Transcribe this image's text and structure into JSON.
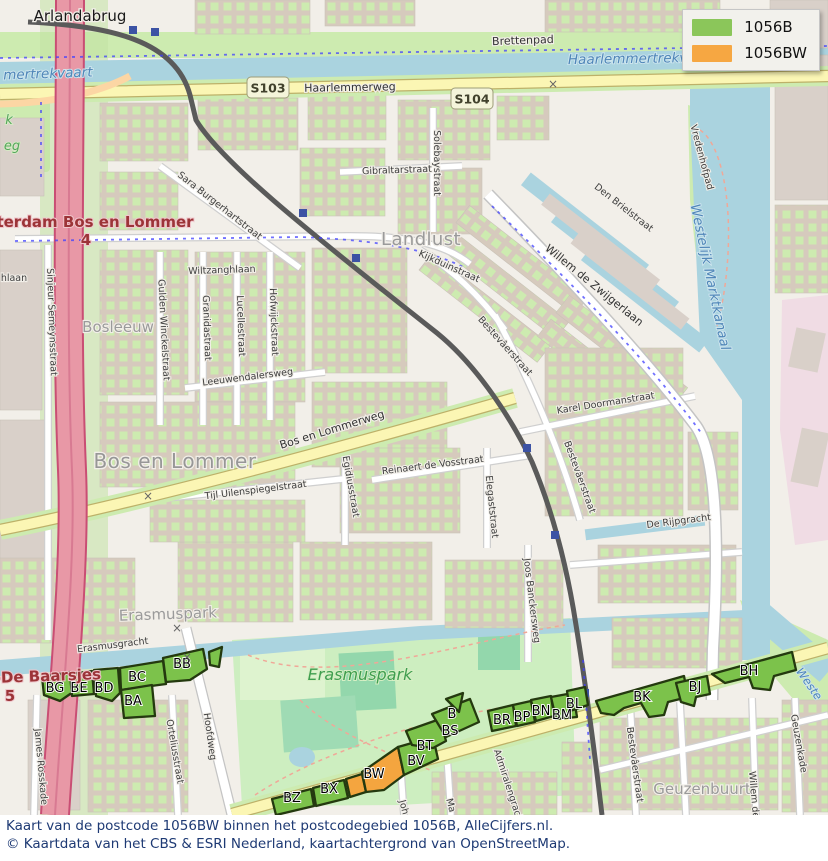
{
  "legend": {
    "items": [
      {
        "label": "1056B",
        "color": "#8bc65a"
      },
      {
        "label": "1056BW",
        "color": "#f6a742"
      }
    ]
  },
  "caption": {
    "line1": "Kaart van de postcode 1056BW binnen het postcodegebied 1056B, AlleCijfers.nl.",
    "line2": "© Kaartdata van het CBS & ESRI Nederland, kaartachtergrond van OpenStreetMap."
  },
  "map": {
    "colors": {
      "area_1056b": "#7cc24b",
      "area_1056bw": "#f4a53f",
      "area_outline": "#24390f",
      "water": "#aad3df",
      "land": "#f2efe9",
      "green": "#cdebb0",
      "motorway": "#e898a6",
      "road_yellow": "#fbf6b4"
    },
    "shields": [
      {
        "label": "S103",
        "x": 268,
        "y": 88
      },
      {
        "label": "S104",
        "x": 472,
        "y": 99
      }
    ],
    "areas": [
      {
        "label": "BG",
        "v": "B",
        "lx": 55,
        "ly": 692,
        "pts": "42,677 70,672 73,692 60,701 44,695"
      },
      {
        "label": "BE",
        "v": "B",
        "lx": 79,
        "ly": 692,
        "pts": "70,674 92,671 94,694 72,696"
      },
      {
        "label": "BD",
        "v": "B",
        "lx": 104,
        "ly": 692,
        "pts": "94,670 118,668 120,693 112,701 96,696"
      },
      {
        "label": "BC",
        "v": "B",
        "lx": 137,
        "ly": 681,
        "pts": "120,668 163,661 166,684 121,690"
      },
      {
        "label": "BA",
        "v": "B",
        "lx": 133,
        "ly": 705,
        "pts": "121,690 152,685 155,716 124,718"
      },
      {
        "label": "BB",
        "v": "B",
        "lx": 182,
        "ly": 668,
        "pts": "163,658 203,649 207,669 190,680 166,682"
      },
      {
        "label": "",
        "v": "B",
        "lx": 0,
        "ly": 0,
        "pts": "209,652 222,647 219,667 210,665"
      },
      {
        "label": "BZ",
        "v": "B",
        "lx": 292,
        "ly": 802,
        "pts": "272,799 311,789 314,806 276,815"
      },
      {
        "label": "BX",
        "v": "B",
        "lx": 329,
        "ly": 793,
        "pts": "313,788 344,780 348,798 316,806"
      },
      {
        "label": "",
        "v": "BW",
        "lx": 0,
        "ly": 0,
        "pts": "346,779 362,774 366,792 350,797"
      },
      {
        "label": "BW",
        "v": "BW",
        "lx": 374,
        "ly": 778,
        "pts": "362,772 398,747 404,775 384,790 366,792"
      },
      {
        "label": "BV",
        "v": "B",
        "lx": 416,
        "ly": 765,
        "pts": "398,747 433,737 438,759 404,775"
      },
      {
        "label": "BT",
        "v": "B",
        "lx": 425,
        "ly": 750,
        "pts": "406,731 440,719 446,741 433,748 412,745"
      },
      {
        "label": "BS",
        "v": "B",
        "lx": 450,
        "ly": 735,
        "pts": "432,714 470,699 479,722 446,737"
      },
      {
        "label": "B",
        "v": "B",
        "lx": 452,
        "ly": 718,
        "pts": "446,699 463,693 459,712"
      },
      {
        "label": "BR",
        "v": "B",
        "lx": 502,
        "ly": 724,
        "pts": "488,711 513,705 516,726 492,731"
      },
      {
        "label": "BP",
        "v": "B",
        "lx": 522,
        "ly": 721,
        "pts": "513,705 531,701 535,722 517,726"
      },
      {
        "label": "BN",
        "v": "B",
        "lx": 541,
        "ly": 715,
        "pts": "531,700 551,696 554,716 536,721"
      },
      {
        "label": "BM",
        "v": "B",
        "lx": 562,
        "ly": 719,
        "pts": "551,697 573,693 577,717 556,719"
      },
      {
        "label": "BL",
        "v": "B",
        "lx": 574,
        "ly": 708,
        "pts": "567,691 585,687 588,705 570,711"
      },
      {
        "label": "BK",
        "v": "B",
        "lx": 642,
        "ly": 701,
        "pts": "596,701 684,676 688,697 668,702 664,715 649,717 641,703 624,708 614,715 601,713"
      },
      {
        "label": "BJ",
        "v": "B",
        "lx": 695,
        "ly": 691,
        "pts": "676,683 707,676 710,694 696,697 694,706 681,702"
      },
      {
        "label": "BH",
        "v": "B",
        "lx": 749,
        "ly": 675,
        "pts": "712,674 792,652 796,670 774,676 770,690 753,688 749,677 725,683"
      }
    ],
    "labels": [
      {
        "t": "Arlandabrug",
        "x": 80,
        "y": 21,
        "r": 0,
        "c": "name-lg"
      },
      {
        "t": "Brettenpad",
        "x": 523,
        "y": 44,
        "r": -2,
        "c": "street-md"
      },
      {
        "t": "Haarlemmertrekvaa",
        "x": 636,
        "y": 63,
        "r": -1,
        "c": "water-lg"
      },
      {
        "t": "mertrekvaart",
        "x": 48,
        "y": 78,
        "r": -2,
        "c": "water-lg"
      },
      {
        "t": "Haarlemmerweg",
        "x": 350,
        "y": 91,
        "r": -1,
        "c": "street-md"
      },
      {
        "t": "Gibraltarstraat",
        "x": 397,
        "y": 173,
        "r": -2,
        "c": "street"
      },
      {
        "t": "Solebaystraat",
        "x": 434,
        "y": 163,
        "r": 90,
        "c": "street"
      },
      {
        "t": "Sara Burgerhartstraat",
        "x": 218,
        "y": 208,
        "r": 38,
        "c": "street"
      },
      {
        "t": "Den Brielstraat",
        "x": 622,
        "y": 210,
        "r": 38,
        "c": "street"
      },
      {
        "t": "Vredenhofpad",
        "x": 699,
        "y": 158,
        "r": 75,
        "c": "street"
      },
      {
        "t": "Westelijk Marktkanaal",
        "x": 706,
        "y": 278,
        "r": 78,
        "c": "water-lg"
      },
      {
        "t": "Landlust",
        "x": 421,
        "y": 245,
        "r": 0,
        "c": "place"
      },
      {
        "t": "Willem de Zwijgerlaan",
        "x": 592,
        "y": 288,
        "r": 39,
        "c": "street-md"
      },
      {
        "t": "Kijkduinstraat",
        "x": 448,
        "y": 269,
        "r": 24,
        "c": "street"
      },
      {
        "t": "hlaan",
        "x": 14,
        "y": 281,
        "r": 0,
        "c": "street"
      },
      {
        "t": "Wiltzanghlaan",
        "x": 222,
        "y": 273,
        "r": -2,
        "c": "street"
      },
      {
        "t": "terdam Bos en Lommer",
        "x": 95,
        "y": 227,
        "r": 0,
        "c": "motorway"
      },
      {
        "t": "4",
        "x": 86,
        "y": 245,
        "r": 0,
        "c": "motorway"
      },
      {
        "t": "Sinjeur Semeynsstraat",
        "x": 49,
        "y": 322,
        "r": 88,
        "c": "street"
      },
      {
        "t": "Bosleeuw",
        "x": 118,
        "y": 332,
        "r": 0,
        "c": "place-sm"
      },
      {
        "t": "Gulden Winckelstraat",
        "x": 161,
        "y": 330,
        "r": 87,
        "c": "street"
      },
      {
        "t": "Granidastraat",
        "x": 204,
        "y": 328,
        "r": 88,
        "c": "street"
      },
      {
        "t": "Lucellestraat",
        "x": 238,
        "y": 326,
        "r": 88,
        "c": "street"
      },
      {
        "t": "Hofwijckstraat",
        "x": 271,
        "y": 322,
        "r": 88,
        "c": "street"
      },
      {
        "t": "Leeuwendalersweg",
        "x": 248,
        "y": 380,
        "r": -7,
        "c": "street"
      },
      {
        "t": "Bestevâerstraat",
        "x": 503,
        "y": 348,
        "r": 48,
        "c": "street"
      },
      {
        "t": "Karel Doormanstraat",
        "x": 606,
        "y": 406,
        "r": -9,
        "c": "street"
      },
      {
        "t": "Bestevâerstraat",
        "x": 577,
        "y": 478,
        "r": 70,
        "c": "street"
      },
      {
        "t": "De Rijpgracht",
        "x": 679,
        "y": 524,
        "r": -7,
        "c": "street"
      },
      {
        "t": "Bos en Lommerweg",
        "x": 333,
        "y": 433,
        "r": -17,
        "c": "street-md"
      },
      {
        "t": "Bos en Lommer",
        "x": 175,
        "y": 468,
        "r": 0,
        "c": "place-lg"
      },
      {
        "t": "Tijl Uilenspiegelstraat",
        "x": 256,
        "y": 493,
        "r": -7,
        "c": "street"
      },
      {
        "t": "Egidiusstraat",
        "x": 348,
        "y": 487,
        "r": 80,
        "c": "street"
      },
      {
        "t": "Reinaert de Vosstraat",
        "x": 433,
        "y": 468,
        "r": -7,
        "c": "street"
      },
      {
        "t": "Elegaststraat",
        "x": 489,
        "y": 507,
        "r": 84,
        "c": "street"
      },
      {
        "t": "Erasmusgracht",
        "x": 113,
        "y": 648,
        "r": -7,
        "c": "street"
      },
      {
        "t": "Erasmuspark",
        "x": 168,
        "y": 619,
        "r": -2,
        "c": "place-sm"
      },
      {
        "t": "Erasmuspark",
        "x": 360,
        "y": 680,
        "r": 0,
        "c": "park"
      },
      {
        "t": "Joos Banckersweg",
        "x": 529,
        "y": 601,
        "r": 83,
        "c": "street"
      },
      {
        "t": "James Rosskade",
        "x": 38,
        "y": 767,
        "r": 85,
        "c": "street"
      },
      {
        "t": "Orteliusstraat",
        "x": 172,
        "y": 752,
        "r": 80,
        "c": "street"
      },
      {
        "t": "Hoofdweg",
        "x": 207,
        "y": 737,
        "r": 82,
        "c": "street"
      },
      {
        "t": "-De Baarsjes",
        "x": 48,
        "y": 681,
        "r": -2,
        "c": "motorway"
      },
      {
        "t": "5",
        "x": 10,
        "y": 701,
        "r": 0,
        "c": "motorway"
      },
      {
        "t": "Bestevâerstraat",
        "x": 632,
        "y": 765,
        "r": 82,
        "c": "street"
      },
      {
        "t": "Geuzenbuurt",
        "x": 702,
        "y": 794,
        "r": 0,
        "c": "place-sm"
      },
      {
        "t": "Willem de",
        "x": 751,
        "y": 795,
        "r": 85,
        "c": "street"
      },
      {
        "t": "Geuzenkade",
        "x": 796,
        "y": 744,
        "r": 80,
        "c": "street"
      },
      {
        "t": "Weste",
        "x": 806,
        "y": 686,
        "r": 55,
        "c": "water"
      },
      {
        "t": "Admiralengracht",
        "x": 506,
        "y": 788,
        "r": 72,
        "c": "street"
      },
      {
        "t": "Joh",
        "x": 401,
        "y": 808,
        "r": 75,
        "c": "street"
      },
      {
        "t": "Ma",
        "x": 448,
        "y": 806,
        "r": 75,
        "c": "street"
      },
      {
        "t": "k",
        "x": 9,
        "y": 124,
        "r": 0,
        "c": "park-sm"
      },
      {
        "t": "eg",
        "x": 12,
        "y": 150,
        "r": 0,
        "c": "park-sm"
      },
      {
        "t": "×",
        "x": 148,
        "y": 500,
        "r": 0,
        "c": "cross"
      },
      {
        "t": "×",
        "x": 177,
        "y": 632,
        "r": 0,
        "c": "cross"
      },
      {
        "t": "×",
        "x": 187,
        "y": 661,
        "r": 0,
        "c": "cross"
      },
      {
        "t": "×",
        "x": 553,
        "y": 88,
        "r": 0,
        "c": "cross"
      }
    ]
  }
}
